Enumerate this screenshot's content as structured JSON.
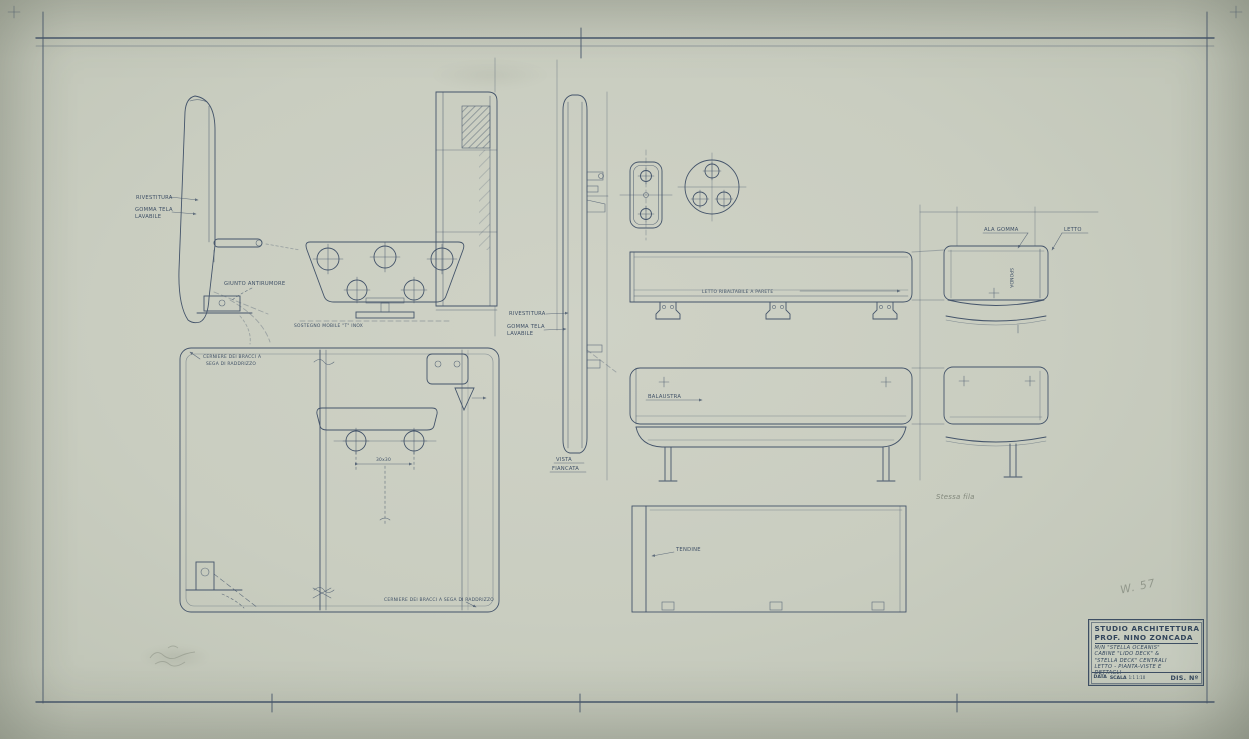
{
  "sheet": {
    "paper_color": "#c9cdc0",
    "ink_color": "#44546a",
    "pencil_color": "#82887c"
  },
  "annotations": {
    "rivestitura_left": "RIVESTITURA",
    "gomma_tela_left": "GOMMA TELA",
    "lavabile_left": "LAVABILE",
    "giunto_antirumore": "GIUNTO ANTIRUMORE",
    "sostegno_mobile": "SOSTEGNO MOBILE \"T\" INOX",
    "cerniere_line1": "CERNIERE DEI BRACCI A",
    "cerniere_line2": "SEGA DI RADDRIZZO",
    "rivestitura_mid": "RIVESTITURA",
    "gomma_tela_mid": "GOMMA TELA",
    "lavabile_mid": "LAVABILE",
    "vista_line1": "VISTA",
    "vista_line2": "FIANCATA",
    "letto_ribaltabile": "LETTO RIBALTABILE A PARETE",
    "balaustra": "BALAUSTRA",
    "tendine": "TENDINE",
    "cerniere_bottom": "CERNIERE DEI BRACCI A SEGA DI RADDRIZZO",
    "ala_gomma": "ALA GOMMA",
    "letto": "LETTO",
    "sponda": "SPONDA",
    "stessa_fila": "Stessa fila",
    "dim_30x30": "30x30",
    "pencil_note": "W. 57"
  },
  "title_block": {
    "studio": "STUDIO ARCHITETTURA",
    "prof": "PROF. NINO ZONCADA",
    "line1": "M/N \"STELLA OCEANIS\"",
    "line2": "CABINE \"LIDO DECK\" &",
    "line3": "\"STELLA DECK\" CENTRALI",
    "line4": "LETTO - PIANTA-VISTE E",
    "line5": "DETTAGLI",
    "data_label": "DATA",
    "scala_label": "SCALA",
    "scala_value": "1:1 1:10",
    "dis_label": "DIS. Nº"
  }
}
